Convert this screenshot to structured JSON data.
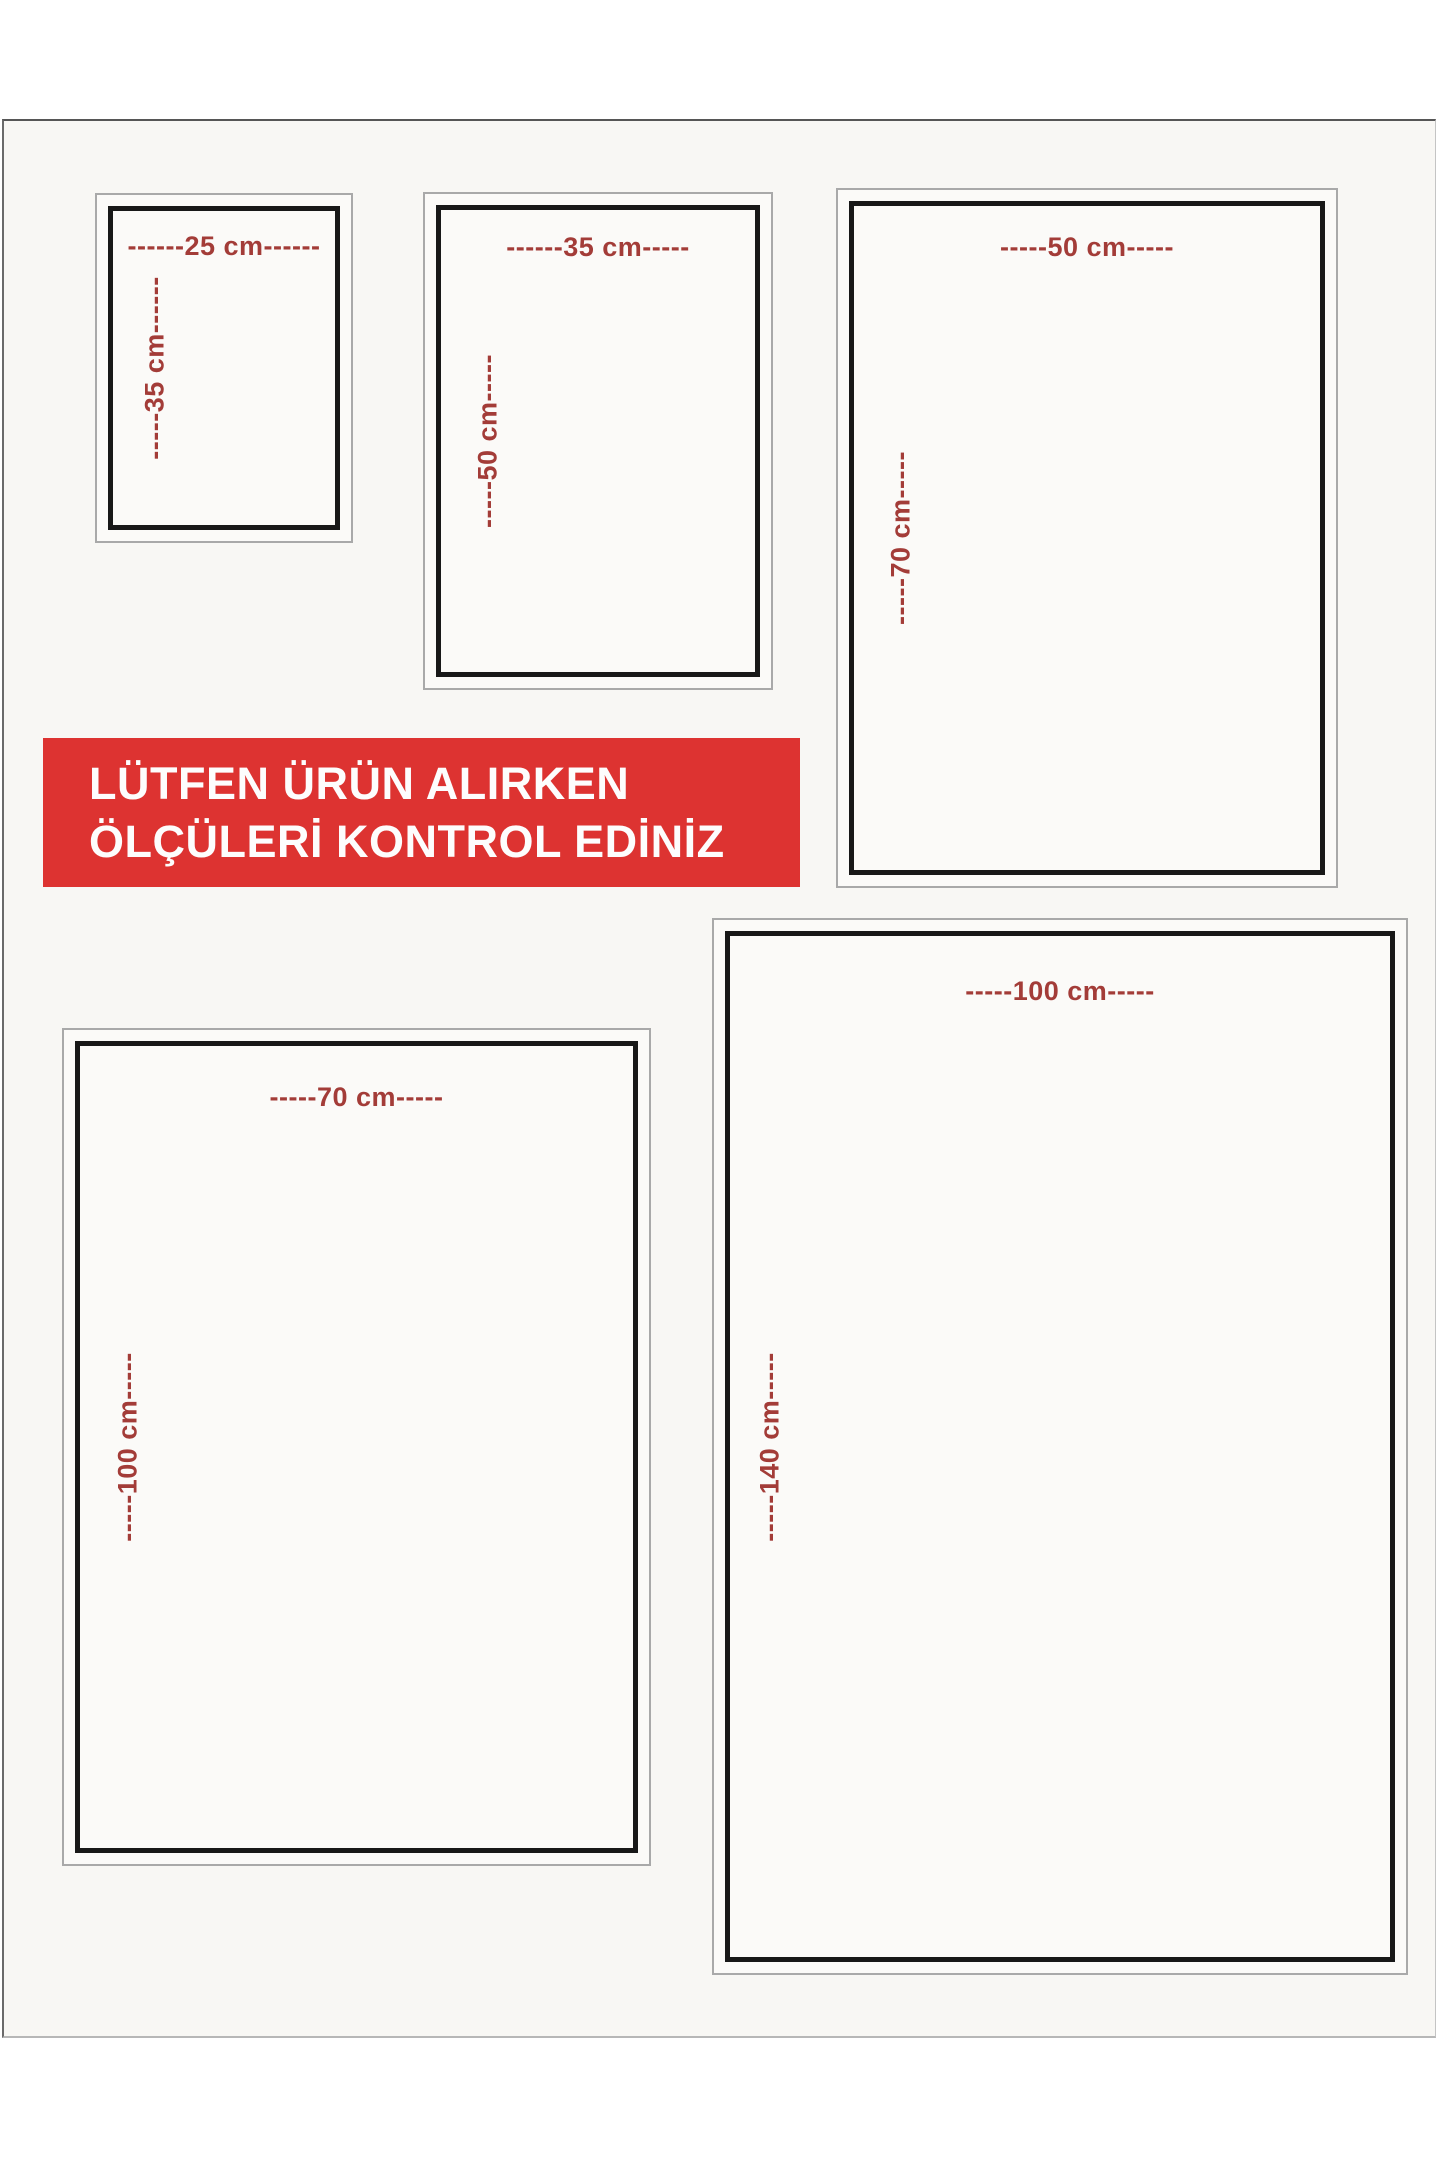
{
  "banner": {
    "line1": "LÜTFEN ÜRÜN ALIRKEN",
    "line2": "ÖLÇÜLERİ KONTROL EDİNİZ",
    "bg_color": "#dd3331",
    "text_color": "#fdfdfd"
  },
  "frames": [
    {
      "size": "25x35 cm",
      "width_label": "------25 cm------",
      "height_label": "-----35 cm------"
    },
    {
      "size": "35x50 cm",
      "width_label": "------35 cm-----",
      "height_label": "-----50 cm-----"
    },
    {
      "size": "50x70 cm",
      "width_label": "-----50 cm-----",
      "height_label": "-----70 cm-----"
    },
    {
      "size": "70x100 cm",
      "width_label": "-----70 cm-----",
      "height_label": "-----100 cm-----"
    },
    {
      "size": "100x140 cm",
      "width_label": "-----100 cm-----",
      "height_label": "-----140 cm-----"
    }
  ],
  "colors": {
    "dimension_text": "#a33c38",
    "inner_frame_border": "#181818",
    "outer_frame_border": "#a9a9a9",
    "poster_background": "#f8f7f4",
    "page_background": "#ffffff"
  }
}
